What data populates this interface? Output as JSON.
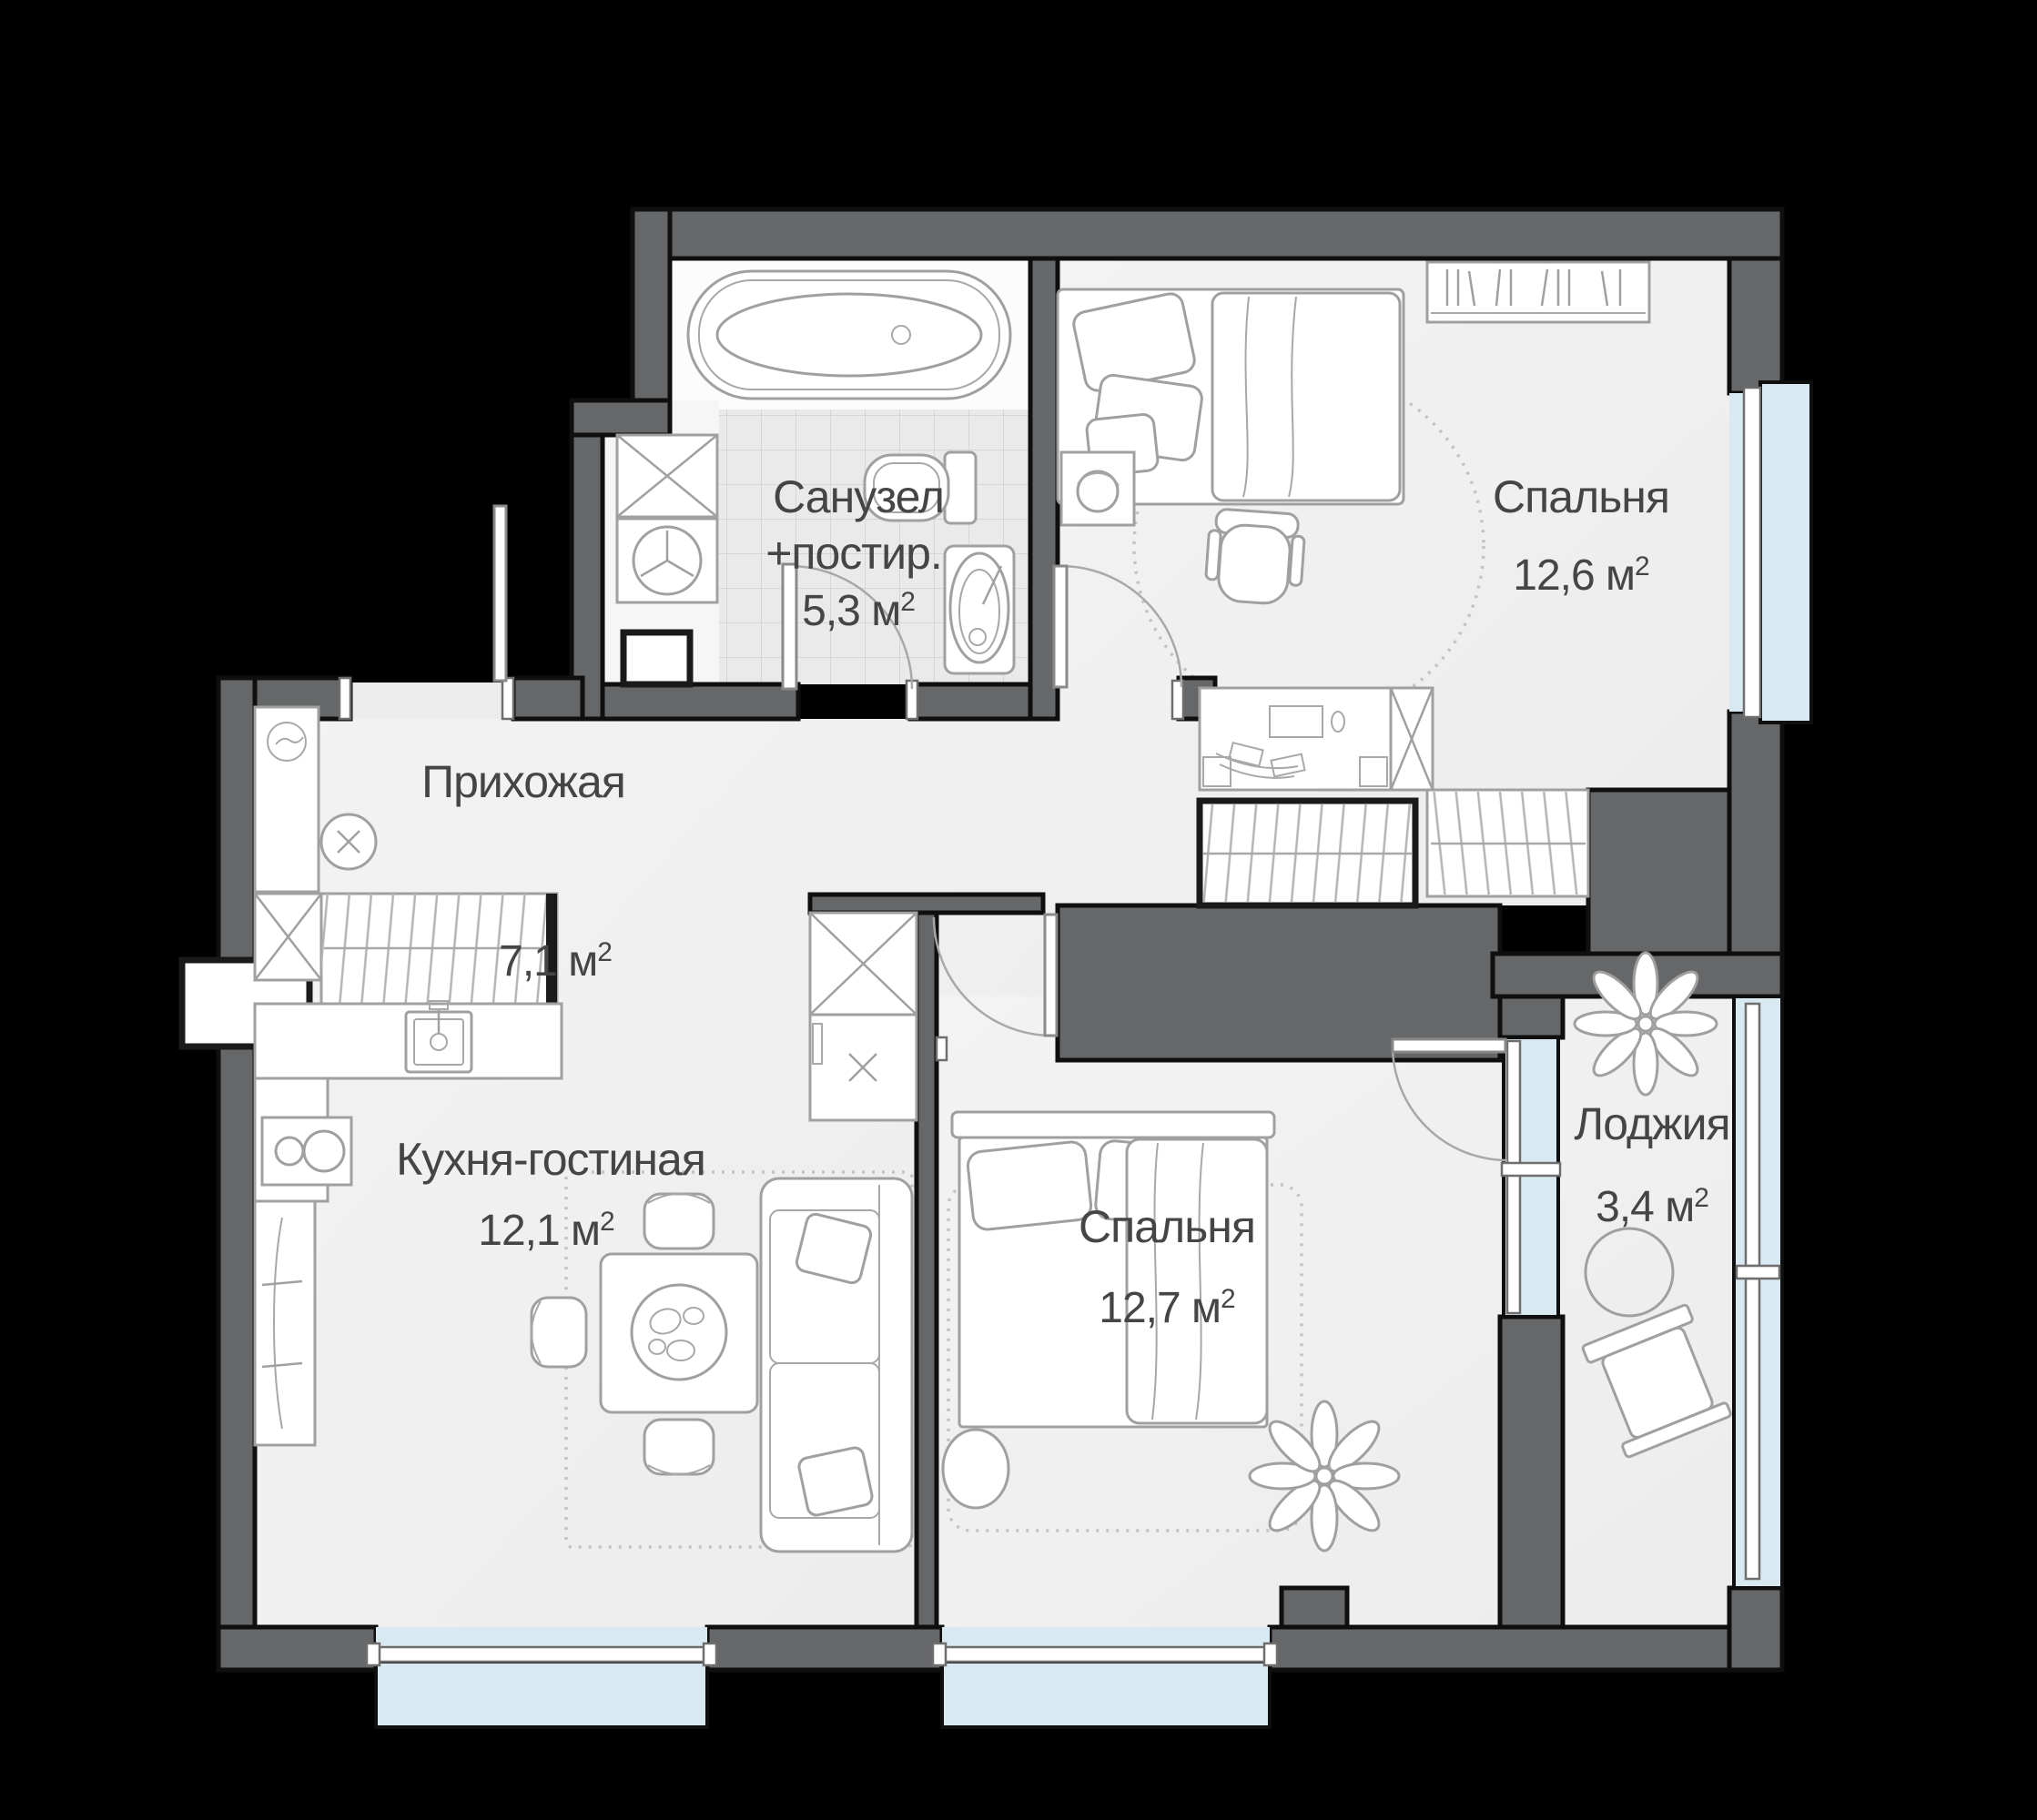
{
  "floorplan": {
    "rooms": [
      {
        "key": "bathroom-laundry",
        "name": "Санузел",
        "name2": "+постир.",
        "area": "5,3 м",
        "area_sup": "2"
      },
      {
        "key": "bedroom-top",
        "name": "Спальня",
        "area": "12,6 м",
        "area_sup": "2"
      },
      {
        "key": "hallway",
        "name": "Прихожая",
        "area": "7,1 м",
        "area_sup": "2"
      },
      {
        "key": "kitchen-living",
        "name": "Кухня-гостиная",
        "area": "12,1 м",
        "area_sup": "2"
      },
      {
        "key": "bedroom-bottom",
        "name": "Спальня",
        "area": "12,7 м",
        "area_sup": "2"
      },
      {
        "key": "loggia",
        "name": "Лоджия",
        "area": "3,4 м",
        "area_sup": "2"
      }
    ],
    "furniture_icons": [
      "bathtub-icon",
      "toilet-icon",
      "washbasin-icon",
      "wardrobe-x-icon",
      "dryer-icon",
      "laundry-box-icon",
      "single-bed-icon",
      "bookshelf-icon",
      "nightstand-headphones-icon",
      "desk-icon",
      "desk-chair-icon",
      "hanging-wardrobe-icon",
      "shoe-console-icon",
      "pouf-icon",
      "kitchen-sink-icon",
      "stove-icon",
      "tall-cabinet-icon",
      "dining-table-icon",
      "dining-chair-icon",
      "sofa-icon",
      "double-bed-icon",
      "plant-icon",
      "loggia-table-icon",
      "loggia-chair-icon"
    ],
    "colors": {
      "background": "#000000",
      "wall": "#666768",
      "floor": "#f1f1f1",
      "tile": "#eaeaea",
      "glass": "#d9e9f1",
      "furniture_line": "#a0a0a0",
      "label": "#454545"
    }
  }
}
